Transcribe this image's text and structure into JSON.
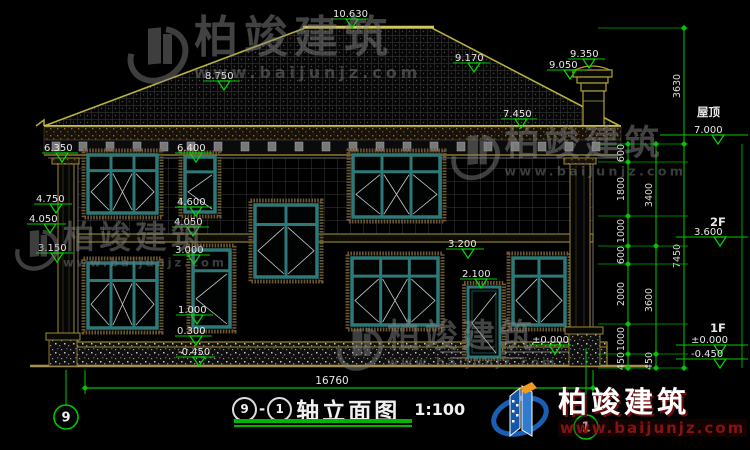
{
  "drawing": {
    "title_block": {
      "axis_start": "9",
      "separator": "-",
      "axis_end": "1",
      "title": "轴立面图",
      "scale": "1:100"
    },
    "grid_bubbles": {
      "left": "9",
      "right": "1"
    },
    "floor_labels": {
      "roof_name": "屋顶",
      "level2": "2F",
      "level1": "1F"
    },
    "dimensions": {
      "bottom_total": "16760",
      "chains": {
        "inner": [
          "600",
          "1800",
          "1000",
          "600",
          "2000",
          "1000",
          "450"
        ],
        "middle": [
          "3400",
          "3600",
          "450"
        ],
        "outer": [
          "3630",
          "7450"
        ]
      }
    },
    "elevation_markers": {
      "ridge": "10.630",
      "eave_left": "6.350",
      "left_475": "4.750",
      "left_405": "4.050",
      "left_315": "3.150",
      "roof_875": "8.750",
      "mid_640": "6.400",
      "mid_460": "4.600",
      "mid_405": "4.050",
      "mid_300": "3.000",
      "mid_100": "1.000",
      "mid_030": "0.300",
      "mid_neg045": "-0.450",
      "door_320": "3.200",
      "door_210": "2.100",
      "porch_000": "±0.000",
      "roof_917": "9.170",
      "chimney_935": "9.350",
      "chimney_905": "9.050",
      "roof_745": "7.450",
      "right_700": "7.000",
      "right_360": "3.600",
      "right_000": "±0.000",
      "right_neg045": "-0.450"
    },
    "watermark": {
      "name": "柏竣建筑",
      "url": "www.baijunjz.com"
    },
    "brand": {
      "name": "柏竣建筑",
      "url": "www.baijunjz.com"
    },
    "colors": {
      "dimension_green": "#00c800",
      "frame_teal": "#2e7878",
      "roof_yellow": "#b8b040",
      "brand_blue": "#1a5fb4",
      "brand_orange": "#f09a20",
      "brand_red": "#8b1111"
    }
  }
}
